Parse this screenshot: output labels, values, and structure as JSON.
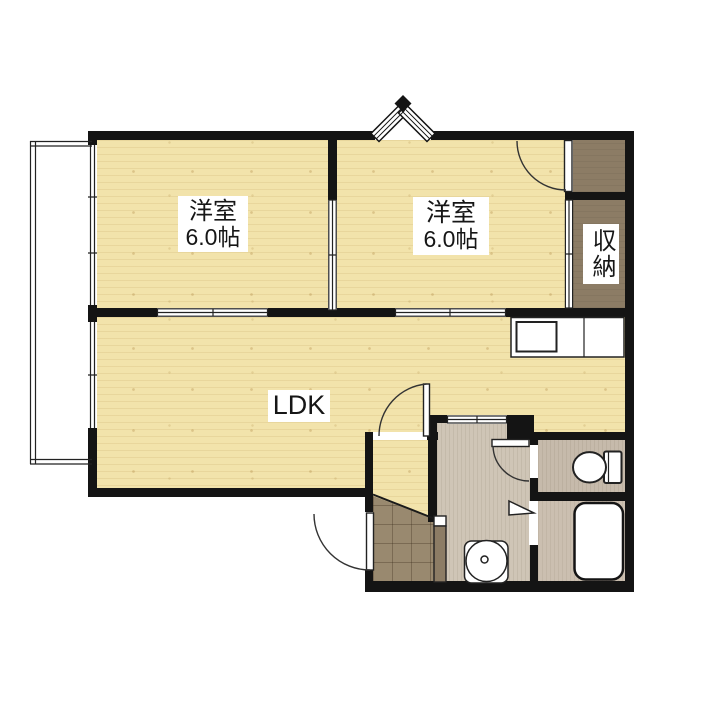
{
  "document": {
    "type": "japanese-apartment-floor-plan"
  },
  "rooms": {
    "bedroom_left": {
      "name": "洋室",
      "size": "6.0帖"
    },
    "bedroom_right": {
      "name": "洋室",
      "size": "6.0帖"
    },
    "ldk": {
      "name": "LDK"
    },
    "storage": {
      "name": "収納"
    }
  },
  "fixtures": {
    "balcony": "balcony",
    "kitchen_counter": "kitchen-counter",
    "kitchen_sink": "kitchen-sink",
    "toilet": "toilet",
    "bathtub": "bathtub",
    "washbasin": "washbasin",
    "entrance_door": "entrance-door",
    "entrance_tile": "entrance-tile",
    "double_casement_window": "outswing-window"
  },
  "colors": {
    "wall": "#141414",
    "wood_floor": "#F2E3AB",
    "closet_floor": "#8C7C65",
    "washroom_floor": "#CFC5B6",
    "toilet_floor": "#C6BAAB",
    "bath_floor": "#CBBFB0",
    "entrance_tile": "#99896F",
    "background": "#FFFFFF"
  }
}
